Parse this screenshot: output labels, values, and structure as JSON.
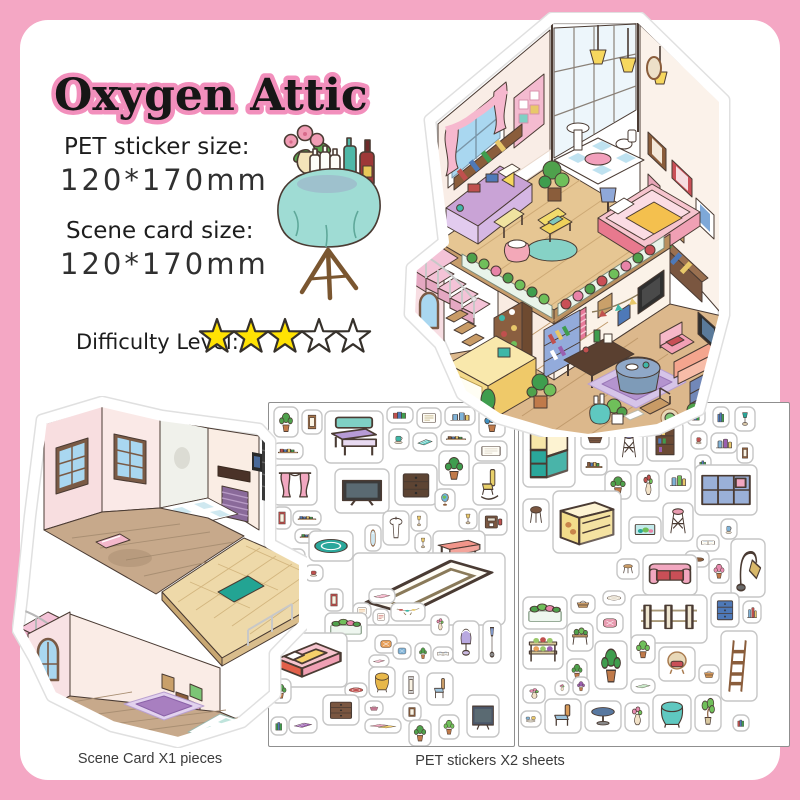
{
  "frame": {
    "background": "#F4A7C4",
    "card_bg": "#FFFFFF"
  },
  "header": {
    "title": "Oxygen Attic",
    "title_color": "#161616",
    "title_outline": "#F28FBC"
  },
  "specs": {
    "pet_label": "PET sticker size:",
    "pet_value": "120*170mm",
    "scene_label": "Scene card size:",
    "scene_value": "120*170mm"
  },
  "difficulty": {
    "label": "Difficulty Level:",
    "stars_filled": 3,
    "stars_total": 5,
    "star_fill": "#FFE203",
    "star_empty": "#FFFFFF",
    "star_outline": "#35302A"
  },
  "captions": {
    "scene_card": "Scene Card X1 pieces",
    "pet_stickers": "PET stickers X2 sheets"
  },
  "illustrations": {
    "attic": "furnished-attic-scene",
    "scene_card": "empty-attic-room-scene-card",
    "side_table": "round-table-with-bottles-and-flowers"
  },
  "sheets": {
    "border_color": "#8F8F8F",
    "sheet1": {
      "stickers": [
        [
          "plant",
          5,
          4,
          24,
          30,
          "#4fa14c"
        ],
        [
          "frame",
          33,
          7,
          20,
          24,
          "#a9764a"
        ],
        [
          "desk",
          56,
          8,
          58,
          52,
          "#b79bd6"
        ],
        [
          "books",
          118,
          4,
          26,
          16,
          "#c0504e"
        ],
        [
          "note",
          148,
          5,
          24,
          20,
          "#b8a878"
        ],
        [
          "bottles",
          176,
          4,
          30,
          18,
          "#7fb3d8"
        ],
        [
          "plant",
          210,
          4,
          26,
          30,
          "#3f8fbf"
        ],
        [
          "shelfrow",
          4,
          40,
          30,
          16,
          "#c0504e"
        ],
        [
          "cup",
          120,
          26,
          20,
          20,
          "#3fb7a8"
        ],
        [
          "mat",
          144,
          30,
          24,
          18,
          "#5fc8c0"
        ],
        [
          "shelfrow",
          172,
          28,
          30,
          14,
          "#8a5d3b"
        ],
        [
          "note",
          206,
          38,
          32,
          20,
          "#d8d0c0"
        ],
        [
          "plant",
          170,
          48,
          30,
          34,
          "#3f9d4e"
        ],
        [
          "curtain",
          4,
          62,
          44,
          40,
          "#f2a7c0"
        ],
        [
          "tv",
          66,
          66,
          54,
          44,
          "#3b3b3b"
        ],
        [
          "dresser",
          126,
          62,
          42,
          40,
          "#5d4433"
        ],
        [
          "rocker",
          204,
          60,
          32,
          42,
          "#e8d06a"
        ],
        [
          "shelfrow",
          24,
          108,
          28,
          14,
          "#4e79b8"
        ],
        [
          "shelfrow",
          26,
          126,
          28,
          14,
          "#3f9d4e"
        ],
        [
          "globe",
          166,
          86,
          20,
          22,
          "#6fb3d8"
        ],
        [
          "lamp",
          190,
          106,
          18,
          20,
          "#e8c86a"
        ],
        [
          "machine",
          210,
          106,
          28,
          26,
          "#7a5640"
        ],
        [
          "frame",
          4,
          104,
          18,
          22,
          "#c0504e"
        ],
        [
          "cubeshelf",
          2,
          146,
          34,
          24,
          "#f2a7c0"
        ],
        [
          "ruground",
          40,
          128,
          44,
          30,
          "#2aa79b"
        ],
        [
          "mirror",
          96,
          122,
          16,
          26,
          "#9ab8c8"
        ],
        [
          "sink",
          114,
          108,
          26,
          34,
          "#e8e8e8"
        ],
        [
          "lamp",
          142,
          108,
          16,
          20,
          "#e8c86a"
        ],
        [
          "lamp",
          146,
          130,
          16,
          20,
          "#e8c86a"
        ],
        [
          "bigtable",
          164,
          128,
          52,
          34,
          "#f2958a"
        ],
        [
          "isoframe",
          84,
          150,
          152,
          72,
          "#b8a888"
        ],
        [
          "cup",
          36,
          162,
          18,
          16,
          "#c0504e"
        ],
        [
          "frame",
          56,
          186,
          18,
          22,
          "#c0504e"
        ],
        [
          "mat",
          100,
          186,
          26,
          14,
          "#f2a7c0"
        ],
        [
          "note",
          84,
          200,
          18,
          16,
          "#e8a05a"
        ],
        [
          "note",
          104,
          206,
          16,
          16,
          "#c0504e"
        ],
        [
          "garland",
          122,
          200,
          34,
          18,
          "#c89b66"
        ],
        [
          "vase",
          162,
          212,
          18,
          20,
          "#e88bb0"
        ],
        [
          "flowerbox",
          56,
          210,
          42,
          28,
          "#4fa14c"
        ],
        [
          "bed",
          2,
          230,
          76,
          54,
          "#f6c4ce"
        ],
        [
          "pillow",
          106,
          232,
          22,
          18,
          "#e8a05a"
        ],
        [
          "pillow",
          124,
          240,
          18,
          16,
          "#7fb3d8"
        ],
        [
          "plant",
          146,
          240,
          16,
          20,
          "#4fa14c"
        ],
        [
          "openbook",
          164,
          244,
          20,
          14,
          "#4e79b8"
        ],
        [
          "domelamp",
          184,
          218,
          26,
          42,
          "#b8a8e0"
        ],
        [
          "floorlamp",
          214,
          218,
          18,
          42,
          "#8098c8"
        ],
        [
          "mat",
          100,
          252,
          20,
          12,
          "#f2a7c0"
        ],
        [
          "clothtable",
          100,
          264,
          26,
          30,
          "#e8b84a"
        ],
        [
          "frame",
          134,
          268,
          16,
          28,
          "#d8d8d8"
        ],
        [
          "chair",
          158,
          270,
          26,
          32,
          "#c89b66"
        ],
        [
          "ruground",
          76,
          280,
          22,
          14,
          "#c0504e"
        ],
        [
          "basket",
          96,
          298,
          18,
          14,
          "#e88bb0"
        ],
        [
          "frame",
          134,
          300,
          18,
          18,
          "#8a5d3b"
        ],
        [
          "plant",
          140,
          317,
          22,
          26,
          "#4fa14c"
        ],
        [
          "plant",
          170,
          312,
          20,
          24,
          "#6fbf5a"
        ],
        [
          "tv",
          198,
          292,
          32,
          42,
          "#4a5568"
        ],
        [
          "dresser",
          54,
          292,
          36,
          30,
          "#7a5640"
        ],
        [
          "mat",
          20,
          314,
          28,
          16,
          "#9a5fb0"
        ],
        [
          "mats",
          96,
          316,
          36,
          14,
          "#f2a7c0"
        ],
        [
          "plant",
          2,
          276,
          20,
          24,
          "#4fa14c"
        ],
        [
          "books",
          2,
          314,
          16,
          18,
          "#3f9d4e"
        ]
      ]
    },
    "sheet2": {
      "stickers": [
        [
          "hutch",
          4,
          10,
          52,
          74,
          "#2aa79b"
        ],
        [
          "basket",
          62,
          24,
          28,
          22,
          "#7a5640"
        ],
        [
          "stool2",
          96,
          24,
          28,
          38,
          "#8f8fc8"
        ],
        [
          "shelfunit",
          128,
          18,
          36,
          40,
          "#6b4a35"
        ],
        [
          "books",
          168,
          4,
          18,
          18,
          "#c0504e"
        ],
        [
          "books",
          194,
          4,
          16,
          20,
          "#4e79b8"
        ],
        [
          "lamp",
          216,
          4,
          20,
          24,
          "#2aa79b"
        ],
        [
          "cup",
          172,
          28,
          16,
          18,
          "#c0504e"
        ],
        [
          "bottles",
          192,
          30,
          26,
          20,
          "#9a5fb0"
        ],
        [
          "shelfrow",
          62,
          52,
          26,
          20,
          "#8a5d3b"
        ],
        [
          "books",
          176,
          52,
          16,
          20,
          "#3f9d4e"
        ],
        [
          "frame",
          218,
          40,
          16,
          20,
          "#8a5d3b"
        ],
        [
          "plant",
          86,
          68,
          26,
          28,
          "#4fa14c"
        ],
        [
          "vase",
          118,
          68,
          22,
          30,
          "#c0504e"
        ],
        [
          "bottles",
          146,
          66,
          26,
          22,
          "#6fbf5a"
        ],
        [
          "cubeshelf",
          176,
          62,
          62,
          50,
          "#9ab0d8"
        ],
        [
          "stool",
          4,
          96,
          26,
          32,
          "#7a5640"
        ],
        [
          "counter",
          34,
          88,
          68,
          62,
          "#f2dc8a"
        ],
        [
          "aquarium",
          110,
          114,
          32,
          26,
          "#2aa79b"
        ],
        [
          "stool2",
          144,
          100,
          30,
          38,
          "#e89bb0"
        ],
        [
          "cup",
          202,
          116,
          16,
          20,
          "#7fb3d8"
        ],
        [
          "openbook",
          178,
          132,
          22,
          16,
          "#4e79b8"
        ],
        [
          "dog",
          166,
          148,
          24,
          16,
          "#8a5d3b"
        ],
        [
          "stool",
          98,
          156,
          22,
          20,
          "#c89b66"
        ],
        [
          "sofa",
          124,
          152,
          54,
          40,
          "#f2a7c0"
        ],
        [
          "plant",
          190,
          156,
          20,
          24,
          "#e88bb0"
        ],
        [
          "arclamp",
          212,
          136,
          34,
          58,
          "#d8b86a"
        ],
        [
          "flowerbox",
          4,
          194,
          44,
          32,
          "#4fa14c"
        ],
        [
          "basket",
          52,
          192,
          24,
          18,
          "#c89b66"
        ],
        [
          "ruground",
          84,
          188,
          22,
          14,
          "#e8e0d0"
        ],
        [
          "fence",
          112,
          192,
          76,
          48,
          "#d8d0b8"
        ],
        [
          "dresser",
          192,
          190,
          28,
          34,
          "#4e79b8"
        ],
        [
          "bottles",
          224,
          198,
          18,
          22,
          "#c0504e"
        ],
        [
          "pillow",
          78,
          210,
          26,
          20,
          "#e89bb0"
        ],
        [
          "plantbench",
          48,
          220,
          26,
          28,
          "#4fa14c"
        ],
        [
          "ladder",
          202,
          228,
          36,
          70,
          "#c89b66"
        ],
        [
          "plant",
          76,
          238,
          32,
          48,
          "#3f9d4e"
        ],
        [
          "plant",
          112,
          232,
          24,
          28,
          "#6fbf5a"
        ],
        [
          "wicker",
          140,
          244,
          36,
          34,
          "#e8d8b8"
        ],
        [
          "basket",
          180,
          262,
          20,
          18,
          "#d89b5a"
        ],
        [
          "mat",
          112,
          276,
          24,
          14,
          "#b8e0b8"
        ],
        [
          "shelfveg",
          4,
          230,
          40,
          36,
          "#9ac86a"
        ],
        [
          "plant",
          48,
          256,
          20,
          24,
          "#4fa14c"
        ],
        [
          "vase",
          36,
          278,
          14,
          14,
          "#e88bb0"
        ],
        [
          "plant",
          54,
          274,
          16,
          18,
          "#9a5fb0"
        ],
        [
          "vase",
          4,
          282,
          22,
          18,
          "#e88bb0"
        ],
        [
          "cupset",
          2,
          308,
          20,
          16,
          "#7fb3d8"
        ],
        [
          "chair",
          26,
          296,
          36,
          34,
          "#d89b5a"
        ],
        [
          "roundtable",
          66,
          298,
          36,
          30,
          "#5878a0"
        ],
        [
          "vase",
          106,
          300,
          24,
          28,
          "#e88bb0"
        ],
        [
          "clothtable",
          134,
          292,
          38,
          38,
          "#5fc8c0"
        ],
        [
          "bonsai",
          176,
          292,
          26,
          36,
          "#6fbf5a"
        ],
        [
          "books",
          214,
          312,
          16,
          16,
          "#c0504e"
        ]
      ]
    }
  }
}
